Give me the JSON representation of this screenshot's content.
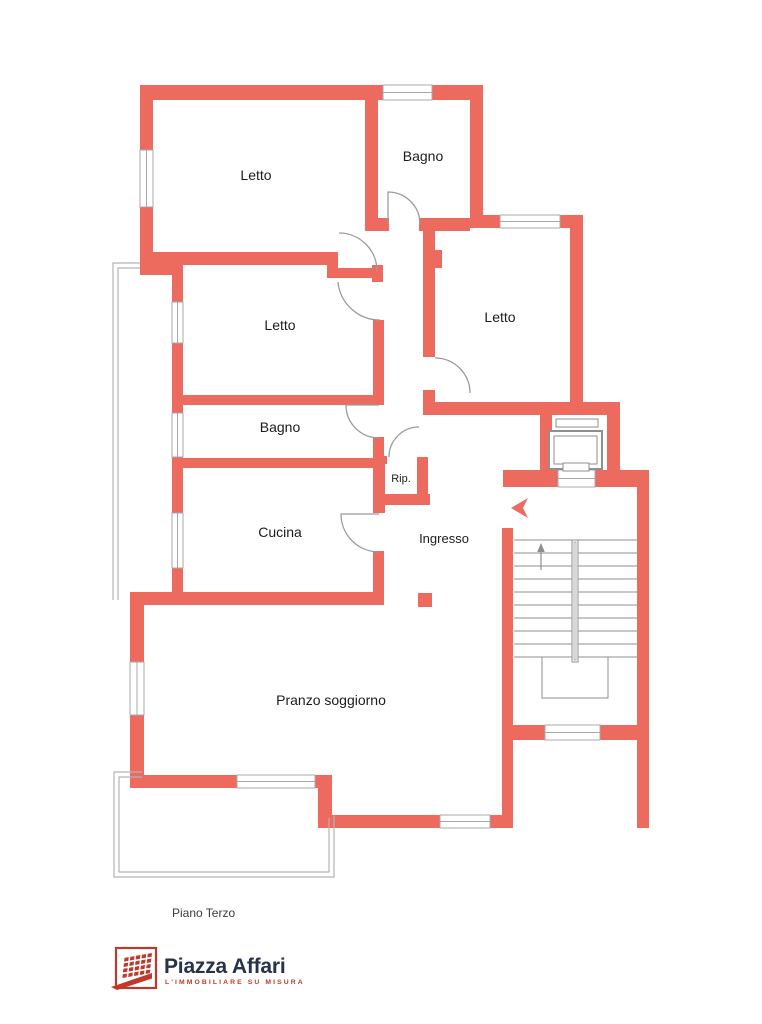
{
  "floorplan": {
    "floor_label": "Piano Terzo",
    "rooms": {
      "letto_top": "Letto",
      "bagno_top": "Bagno",
      "letto_right": "Letto",
      "letto_middle": "Letto",
      "bagno_middle": "Bagno",
      "cucina": "Cucina",
      "ripostiglio": "Rip.",
      "ingresso": "Ingresso",
      "pranzo_soggiorno": "Pranzo soggiorno"
    }
  },
  "branding": {
    "name": "Piazza Affari",
    "tagline": "L'IMMOBILIARE SU MISURA"
  },
  "colors": {
    "wall": "#ed6a5f",
    "outline": "#9b9b9b",
    "balcony_line": "#b3b3b3",
    "label_text": "#1c1c1c",
    "floor_label_text": "#3c3c3c",
    "logo_red": "#bf3a2b",
    "logo_navy": "#273349",
    "background": "#ffffff"
  }
}
